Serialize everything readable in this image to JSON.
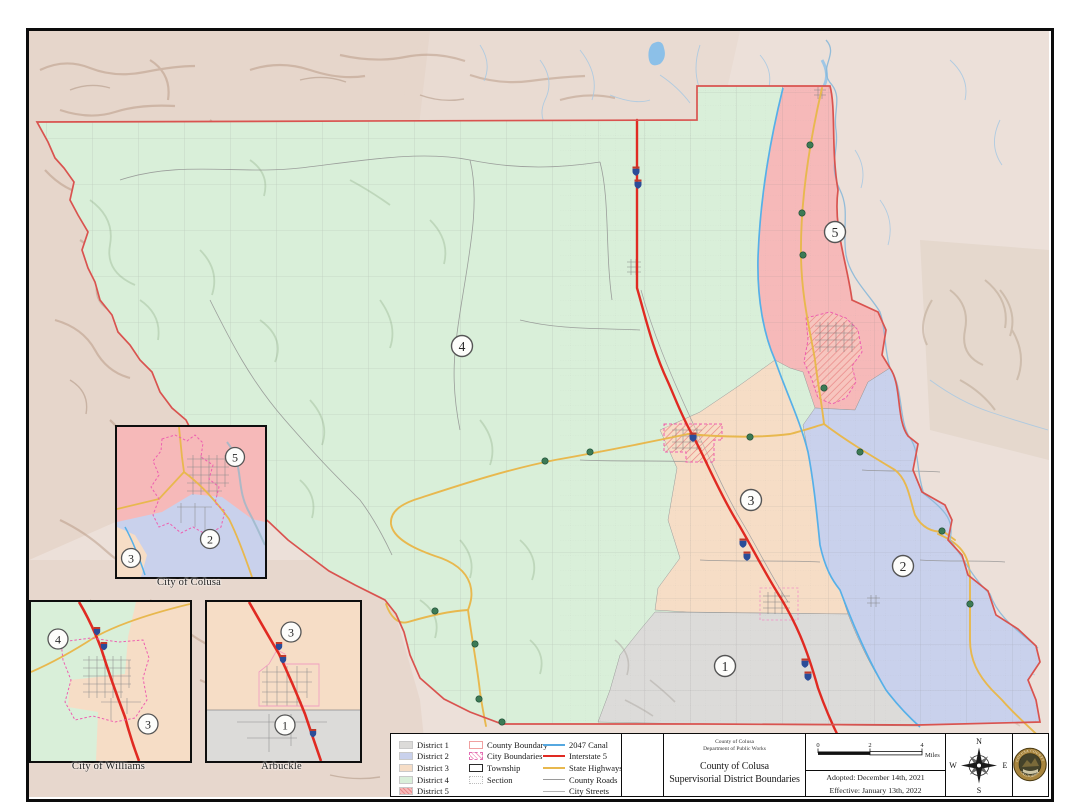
{
  "map": {
    "name": "Colusa County supervisorial districts map",
    "districts": [
      {
        "number": "1",
        "label": "District 1",
        "color": "#dcdbd9"
      },
      {
        "number": "2",
        "label": "District 2",
        "color": "#c9d1ec"
      },
      {
        "number": "3",
        "label": "District 3",
        "color": "#f6ddc6"
      },
      {
        "number": "4",
        "label": "District 4",
        "color": "#d9efd9"
      },
      {
        "number": "5",
        "label": "District 5",
        "color": "#f6b9b9"
      }
    ],
    "boundary_color": "#d9534f"
  },
  "legend": {
    "district_items": [
      "District 1",
      "District 2",
      "District 3",
      "District 4",
      "District 5"
    ],
    "boundary_items": [
      "County Boundary",
      "City Boundaries",
      "Township",
      "Section"
    ],
    "line_items": [
      {
        "label": "2047 Canal",
        "color": "#56a8e0"
      },
      {
        "label": "Interstate 5",
        "color": "#e02a22"
      },
      {
        "label": "State Highways",
        "color": "#e8b84e"
      },
      {
        "label": "County Roads",
        "color": "#9a9a9a"
      },
      {
        "label": "City Streets",
        "color": "#b5b5b5"
      }
    ]
  },
  "title_block": {
    "agency_line1": "County of Colusa",
    "agency_line2": "Department of Public Works",
    "title_line1": "County of Colusa",
    "title_line2": "Supervisorial District Boundaries"
  },
  "scale_bar": {
    "tick0": "0",
    "tick1": "2",
    "tick2": "4",
    "unit": "Miles"
  },
  "dates": {
    "adopted": "Adopted: December 14th, 2021",
    "effective": "Effective: January 13th, 2022"
  },
  "compass": {
    "n": "N",
    "e": "E",
    "s": "S",
    "w": "W"
  },
  "seal": {
    "top_text": "COLUSA COUNTY",
    "bottom_text": "CALIFORNIA"
  },
  "insets": {
    "colusa": {
      "label": "City of Colusa",
      "markers": [
        "5",
        "2",
        "3"
      ]
    },
    "williams": {
      "label": "City of Williams",
      "markers": [
        "4",
        "3"
      ]
    },
    "arbuckle": {
      "label": "Arbuckle",
      "markers": [
        "3",
        "1"
      ]
    }
  }
}
